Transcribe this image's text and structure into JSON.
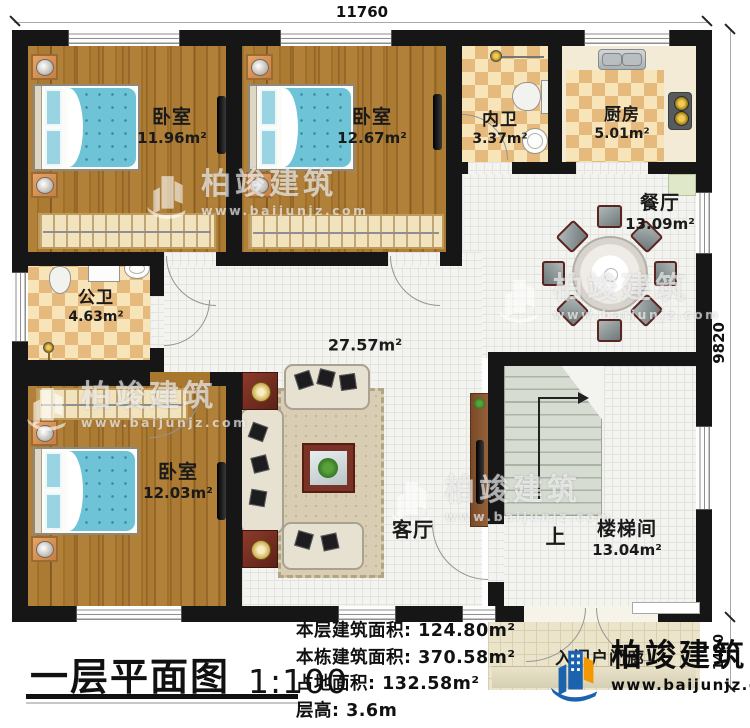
{
  "dimensions": {
    "top": "11760",
    "right": "9820",
    "porch": "1420"
  },
  "rooms": {
    "bedroom_tl": {
      "name": "卧室",
      "area": "11.96m²"
    },
    "bedroom_tm": {
      "name": "卧室",
      "area": "12.67m²"
    },
    "bath_inner": {
      "name": "内卫",
      "area": "3.37m²"
    },
    "kitchen": {
      "name": "厨房",
      "area": "5.01m²"
    },
    "dining": {
      "name": "餐厅",
      "area": "13.09m²"
    },
    "bath_public": {
      "name": "公卫",
      "area": "4.63m²"
    },
    "living": {
      "name": "客厅",
      "area": "27.57m²"
    },
    "bedroom_bl": {
      "name": "卧室",
      "area": "12.03m²"
    },
    "stairwell": {
      "name": "楼梯间",
      "area": "13.04m²",
      "direction": "上"
    },
    "porch": {
      "name": "入门户门廊"
    }
  },
  "footer": {
    "title": "一层平面图",
    "scale": "1:100",
    "stats": [
      {
        "label": "本层建筑面积:",
        "value": "124.80m²"
      },
      {
        "label": "本栋建筑面积:",
        "value": "370.58m²"
      },
      {
        "label": "占地面积:",
        "value": "132.58m²"
      },
      {
        "label": "层高:",
        "value": "3.6m"
      }
    ],
    "brand": {
      "name": "柏竣建筑",
      "website": "www.baijunjz.com"
    }
  },
  "watermark": {
    "name": "柏竣建筑",
    "website": "www.baijunjz.com"
  },
  "colors": {
    "wall": "#161616",
    "wood": "#a9782f",
    "tile": "#f3f3f0",
    "checker_light": "#f7e5b9",
    "checker_dark": "#e6ba7c",
    "bed": "#6fc3d6",
    "brand_blue": "#1b63ae",
    "brand_orange": "#f39800"
  }
}
